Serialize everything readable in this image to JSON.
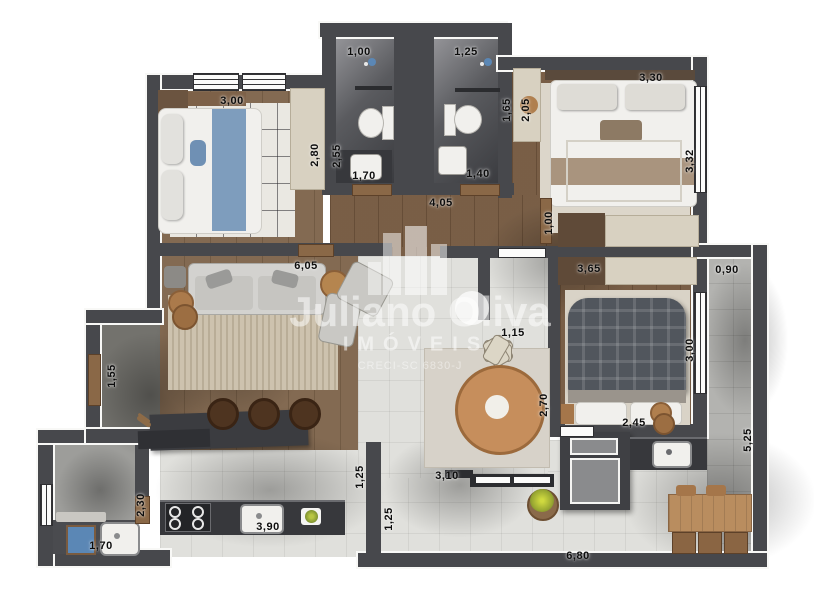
{
  "watermark": {
    "brand": "Juliano Oliva",
    "subtitle": "IMÓVEIS",
    "license": "CRECI-SC 6830-J"
  },
  "dimensions": [
    {
      "name": "bathroom1-width",
      "value": "1,00",
      "orientation": "horizontal"
    },
    {
      "name": "bathroom2-width",
      "value": "1,25",
      "orientation": "horizontal"
    },
    {
      "name": "bedroom1-width",
      "value": "3,00",
      "orientation": "horizontal"
    },
    {
      "name": "bedroom1-closet-depth",
      "value": "2,80",
      "orientation": "vertical"
    },
    {
      "name": "bathroom1-depth",
      "value": "2,55",
      "orientation": "vertical"
    },
    {
      "name": "bathroom2-depth",
      "value": "1,65",
      "orientation": "vertical"
    },
    {
      "name": "suite-closet-depth",
      "value": "2,05",
      "orientation": "vertical"
    },
    {
      "name": "suite-width",
      "value": "3,30",
      "orientation": "horizontal"
    },
    {
      "name": "suite-depth",
      "value": "3,32",
      "orientation": "vertical"
    },
    {
      "name": "bathroom1-door",
      "value": "1,70",
      "orientation": "horizontal"
    },
    {
      "name": "bathroom2-door",
      "value": "1,40",
      "orientation": "horizontal"
    },
    {
      "name": "hall-length",
      "value": "4,05",
      "orientation": "horizontal"
    },
    {
      "name": "hall-corridor-width",
      "value": "1,00",
      "orientation": "vertical"
    },
    {
      "name": "bedroom2-closet-width",
      "value": "3,65",
      "orientation": "horizontal"
    },
    {
      "name": "balcony-width",
      "value": "0,90",
      "orientation": "horizontal"
    },
    {
      "name": "living-width",
      "value": "6,05",
      "orientation": "horizontal"
    },
    {
      "name": "entry-width",
      "value": "1,55",
      "orientation": "vertical"
    },
    {
      "name": "dining-opening",
      "value": "1,15",
      "orientation": "horizontal"
    },
    {
      "name": "dining-depth",
      "value": "2,70",
      "orientation": "vertical"
    },
    {
      "name": "bedroom2-depth",
      "value": "3,00",
      "orientation": "vertical"
    },
    {
      "name": "bedroom2-bed-width",
      "value": "2,45",
      "orientation": "horizontal"
    },
    {
      "name": "balcony-length",
      "value": "5,25",
      "orientation": "vertical"
    },
    {
      "name": "kitchen-passage",
      "value": "1,25",
      "orientation": "vertical"
    },
    {
      "name": "terrace-passage",
      "value": "1,25",
      "orientation": "vertical"
    },
    {
      "name": "kitchen-opening",
      "value": "3,10",
      "orientation": "horizontal"
    },
    {
      "name": "laundry-depth",
      "value": "2,30",
      "orientation": "vertical"
    },
    {
      "name": "laundry-width",
      "value": "1,70",
      "orientation": "horizontal"
    },
    {
      "name": "kitchen-counter",
      "value": "3,90",
      "orientation": "horizontal"
    },
    {
      "name": "terrace-length",
      "value": "6,80",
      "orientation": "horizontal"
    }
  ],
  "colors": {
    "wall": "#47484c",
    "wood_floor": "#7f654c",
    "tile_light": "#e0e0dc",
    "tile_balcony": "#b3b3b0",
    "bath_floor_dark": "#3a3b3f",
    "closet_beige": "#d8d1c1",
    "counter_dark": "#37383c",
    "bed_blue_runner": "#7e9dbd",
    "bed_beige_runner": "#a9947e",
    "plaid_blanket": "#51565d",
    "dining_table_wood": "#c68e5c",
    "laundry_tub_blue": "#5b87b5",
    "plant_green": "#a8b83c",
    "label_text": "#0d0d0d"
  },
  "icons": [
    "shower-icon",
    "key-icon",
    "plant-icon",
    "faucet-icon",
    "cooktop-burners-icon",
    "building-logo-icon"
  ]
}
